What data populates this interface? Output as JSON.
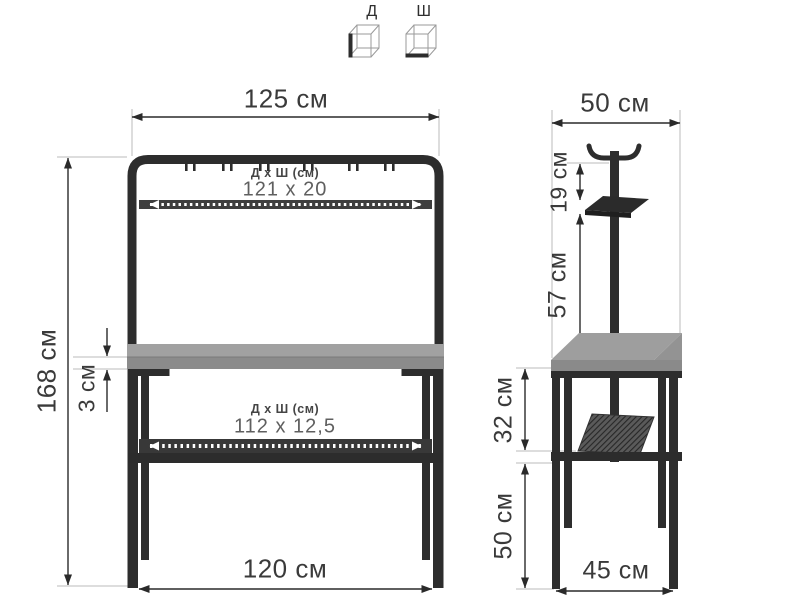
{
  "legend": {
    "length_label": "Д",
    "width_label": "Ш"
  },
  "front_view": {
    "overall_width": "125 см",
    "overall_height": "168 см",
    "top_shelf_dims_title": "Д х Ш (см)",
    "top_shelf_dims_value": "121 х 20",
    "tabletop_thickness": "3 см",
    "lower_shelf_dims_title": "Д х Ш (см)",
    "lower_shelf_dims_value": "112 х 12,5",
    "base_width": "120 см"
  },
  "side_view": {
    "overall_depth": "50 см",
    "hook_bar_to_shelf": "19 см",
    "shelf_to_tabletop": "57 см",
    "tabletop_to_shelf": "32 см",
    "shelf_to_floor": "50 см",
    "base_depth": "45 см"
  },
  "colors": {
    "metal": "#2d2d2d",
    "wood_top": "#9e9e9e",
    "wood_edge": "#8a8a8a",
    "dimension_line": "#2a2a2a",
    "extension_line": "#bbbbbb"
  }
}
